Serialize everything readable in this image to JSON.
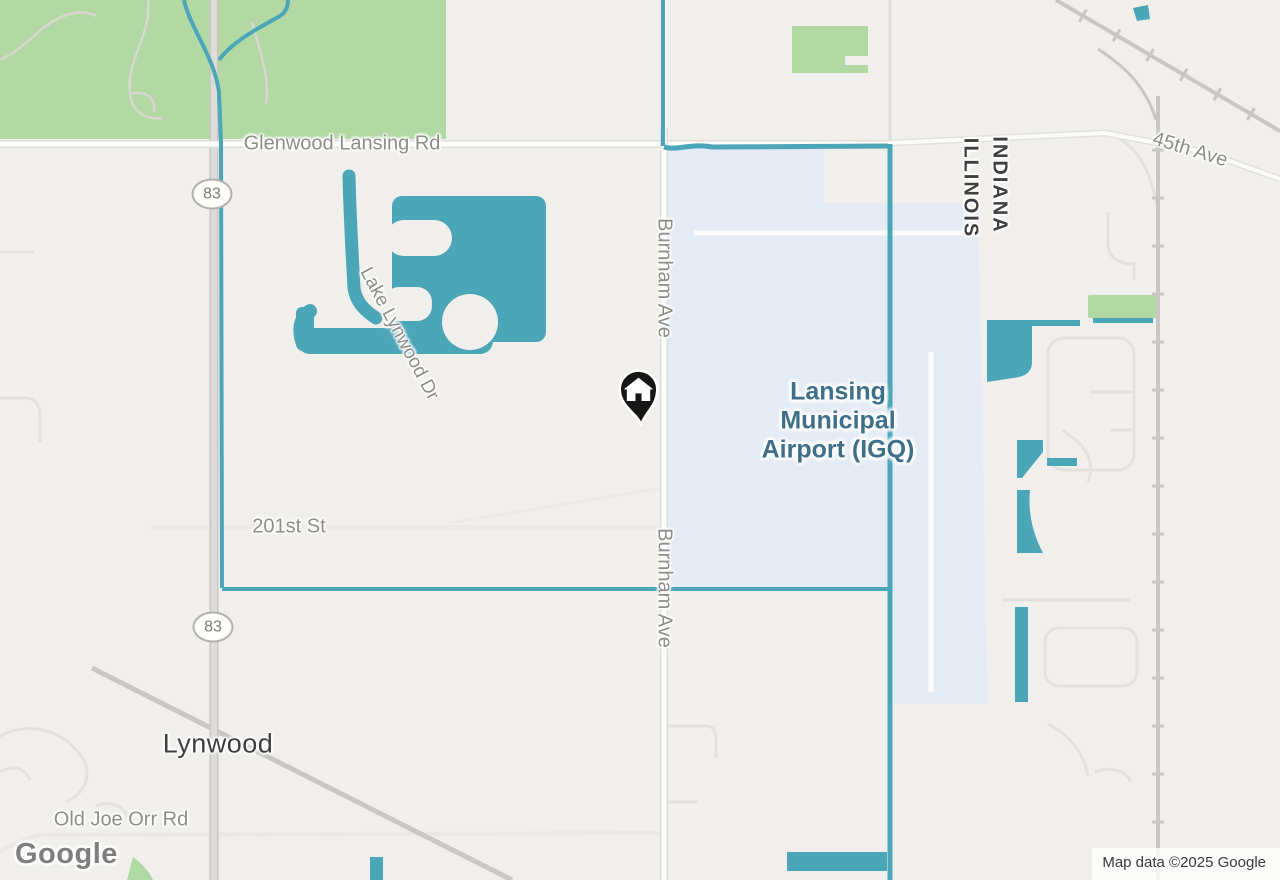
{
  "map": {
    "road_labels": {
      "glenwood": "Glenwood Lansing Rd",
      "burnham_north": "Burnham Ave",
      "burnham_south": "Burnham Ave",
      "lake_lynwood_dr": "Lake Lynwood Dr",
      "street_201": "201st St",
      "ave_45": "45th Ave",
      "old_joe_orr": "Old Joe Orr Rd"
    },
    "place_labels": {
      "city": "Lynwood",
      "state_east": "INDIANA",
      "state_west": "ILLINOIS",
      "airport_line1": "Lansing",
      "airport_line2": "Municipal",
      "airport_line3": "Airport (IGQ)"
    },
    "route_shield": "83",
    "marker": {
      "type": "home-pin",
      "color": "#111111"
    },
    "colors": {
      "land": "#f0efeb",
      "park": "#b2d9a3",
      "water": "#4ba6b7",
      "airport": "#e4ebf5",
      "road": "#ffffff",
      "railroad": "#c9c7c4",
      "airport_label": "#3e7089"
    },
    "footer": {
      "logo": "Google",
      "attribution": "Map data ©2025 Google"
    }
  }
}
